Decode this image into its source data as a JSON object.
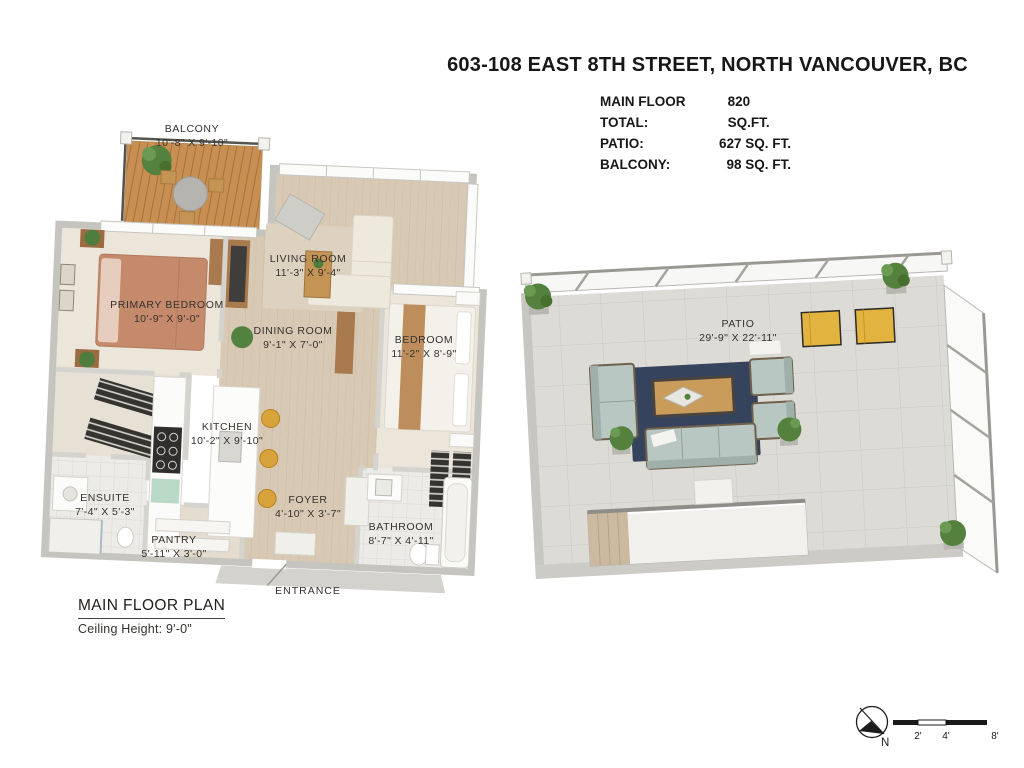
{
  "header": {
    "title": "603-108 EAST 8TH STREET, NORTH VANCOUVER, BC",
    "stats": [
      {
        "label": "MAIN FLOOR TOTAL:",
        "value": "820 SQ.FT."
      },
      {
        "label": "PATIO:",
        "value": "627 SQ. FT."
      },
      {
        "label": "BALCONY:",
        "value": "98 SQ. FT."
      }
    ]
  },
  "plan_caption": {
    "title": "MAIN FLOOR PLAN",
    "subtitle": "Ceiling Height: 9'-0\""
  },
  "main_floor": {
    "entrance_label": "ENTRANCE",
    "rooms": [
      {
        "id": "balcony",
        "name": "BALCONY",
        "dims": "10'-8\" X 9'-10\""
      },
      {
        "id": "living-room",
        "name": "LIVING ROOM",
        "dims": "11'-3\" X 9'-4\""
      },
      {
        "id": "primary-bedroom",
        "name": "PRIMARY BEDROOM",
        "dims": "10'-9\" X 9'-0\""
      },
      {
        "id": "dining-room",
        "name": "DINING ROOM",
        "dims": "9'-1\" X 7'-0\""
      },
      {
        "id": "bedroom",
        "name": "BEDROOM",
        "dims": "11'-2\" X 8'-9\""
      },
      {
        "id": "kitchen",
        "name": "KITCHEN",
        "dims": "10'-2\" X 9'-10\""
      },
      {
        "id": "ensuite",
        "name": "ENSUITE",
        "dims": "7'-4\" X 5'-3\""
      },
      {
        "id": "foyer",
        "name": "FOYER",
        "dims": "4'-10\" X 3'-7\""
      },
      {
        "id": "pantry",
        "name": "PANTRY",
        "dims": "5'-11\" X 3'-0\""
      },
      {
        "id": "bathroom",
        "name": "BATHROOM",
        "dims": "8'-7\" X 4'-11\""
      }
    ]
  },
  "patio_plan": {
    "name": "PATIO",
    "dims": "29'-9\" X 22'-11\""
  },
  "compass": {
    "north_label": "N"
  },
  "scale_bar": {
    "tick_labels": [
      "2'",
      "4'",
      "8'"
    ]
  },
  "palette": {
    "wood_floor": "#d8c9b4",
    "balcony_deck": "#c78f52",
    "primary_bed": "#c58a6b",
    "bar_stools": "#d9a33c",
    "patio_tile": "#dcdbd6",
    "patio_rug": "#36435c",
    "outdoor_cushion": "#b9c7c3",
    "yellow_chairs": "#e3b33f",
    "plant_green": "#55813f",
    "wall_gray": "#c6c4bf",
    "text_dark": "#35322e"
  }
}
